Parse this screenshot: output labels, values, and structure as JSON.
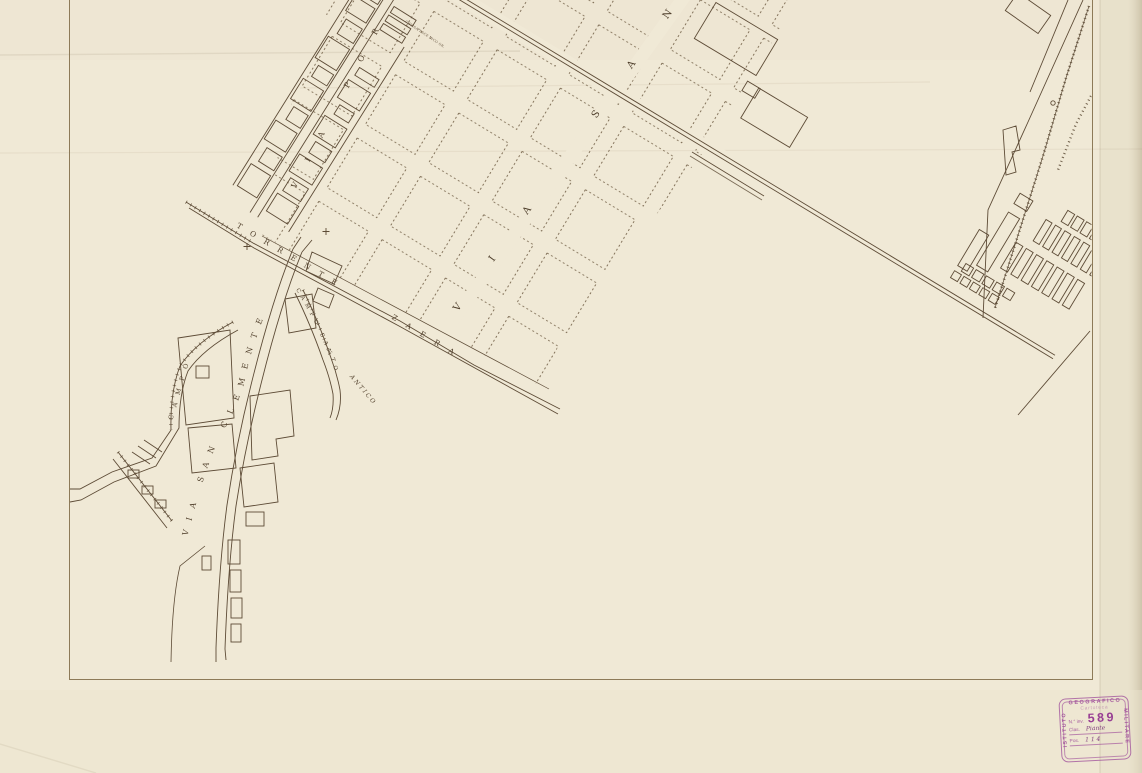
{
  "map": {
    "street_labels": {
      "via_por": "VIA POR",
      "via_san": "VIA SAN",
      "torrente": "TORRENTE",
      "zaera": "ZAERA",
      "via_san_clemente": "VIA SAN CLEMENTE",
      "campo": "CAMPO",
      "campo_santo": "CAMPO SANTO",
      "antico": "ANTICO",
      "tiny_1": "CHIESA",
      "tiny_2": "PESCE D.",
      "tiny_3": "VICO OR."
    }
  },
  "stamp": {
    "top": "GEOGRAFICO",
    "left": "ISTITUTO",
    "right": "MILITARE",
    "line1": "Cartoteca",
    "inv_label": "N.° inv.",
    "inv_number": "589",
    "clas_label": "Clas.",
    "clas_value": "Piante",
    "pos_label": "Pos.",
    "pos_value": "1 1 4",
    "ink_color": "#9e4c99"
  },
  "colors": {
    "paper": "#f0e9d6",
    "ink": "#5d4b36",
    "frame": "#8d7a58",
    "block_dash": "#6e5b42"
  }
}
